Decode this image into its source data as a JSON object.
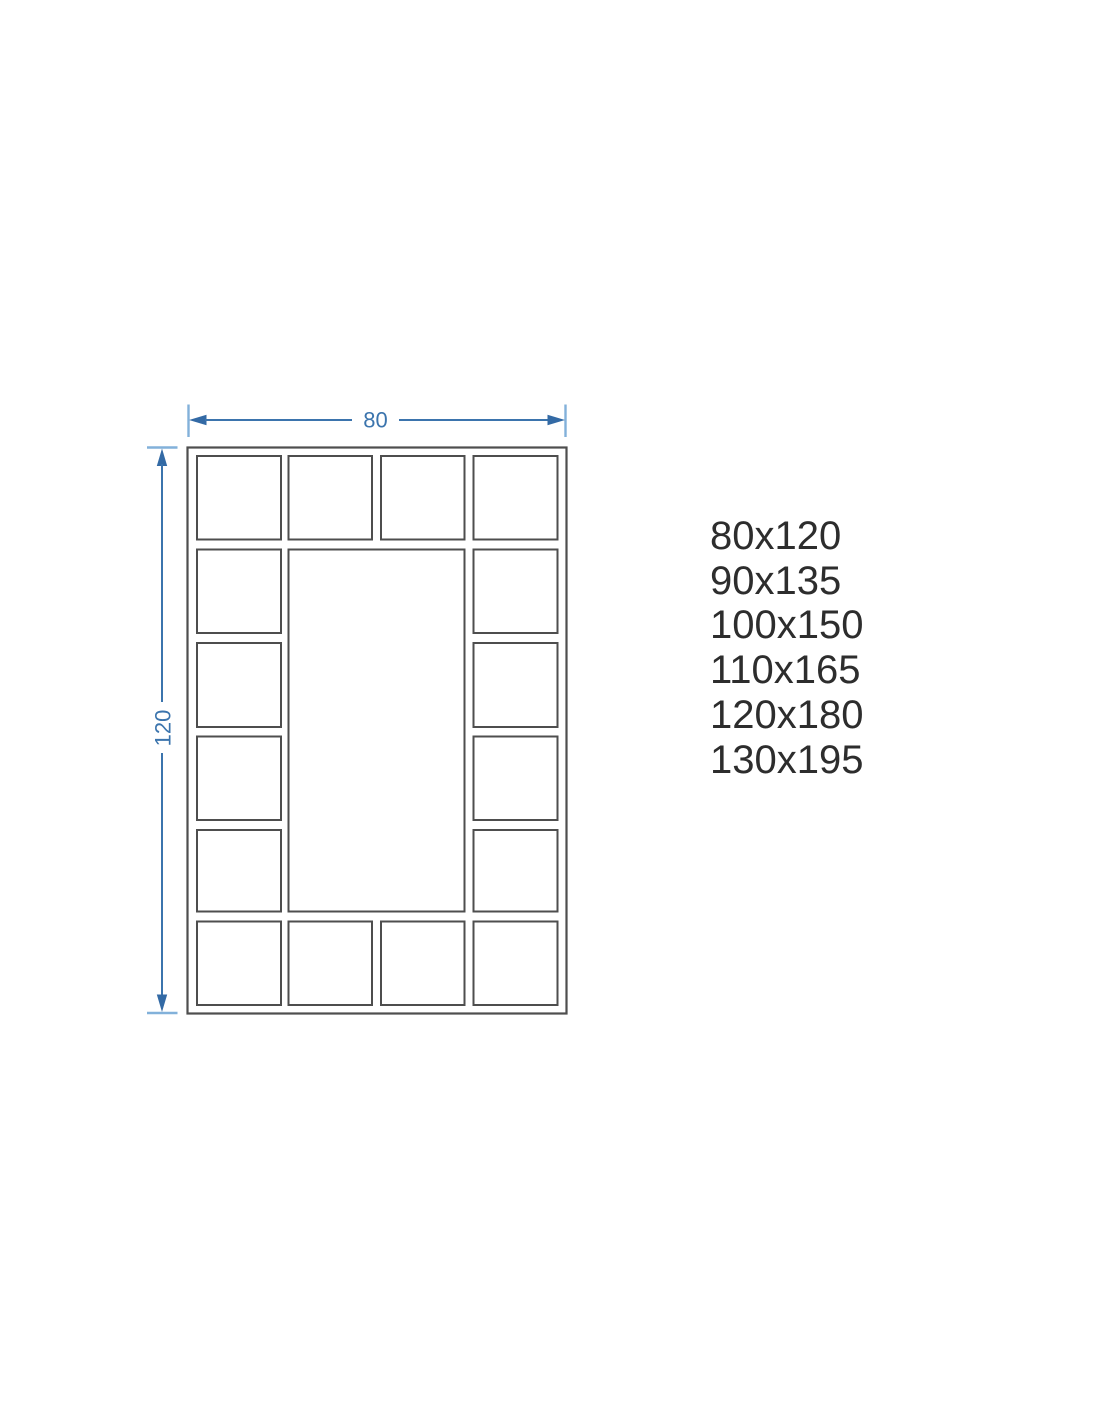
{
  "drawing": {
    "width_dimension": {
      "label": "80"
    },
    "height_dimension": {
      "label": "120"
    },
    "description": "Rectangular frame with perimeter grid of 16 small panels around one large center panel"
  },
  "size_list": {
    "items": [
      "80x120",
      "90x135",
      "100x150",
      "110x165",
      "120x180",
      "130x195"
    ]
  },
  "colors": {
    "dimension_blue": "#3b74ad",
    "extension_tick_blue": "#82b1da",
    "frame_gray": "#4e4e4e",
    "size_text": "#2d2d2d",
    "background": "#ffffff"
  }
}
